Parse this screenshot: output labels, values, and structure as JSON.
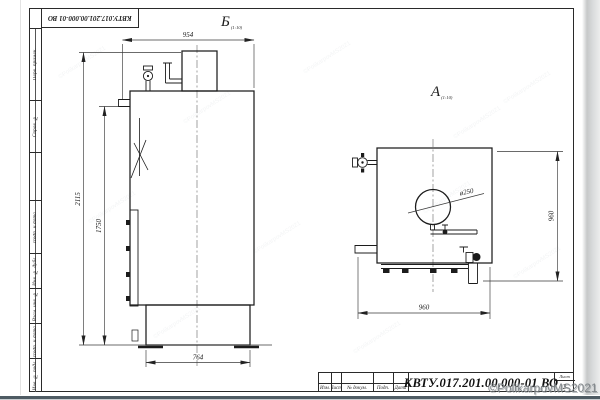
{
  "sheet": {
    "corner_stamp": "КВТУ.017.201.00.000-01 ВО"
  },
  "strip": {
    "cells": [
      "Перв. примен.",
      "Справ. №",
      "",
      "Подп. и дата",
      "Инв. № дубл.",
      "Взам. инв. №",
      "Подп. и дата",
      "Инв. № подл."
    ]
  },
  "views": {
    "b": {
      "label": "Б",
      "scale": "(1:10)",
      "dims": {
        "top_width": "954",
        "overall_height": "2115",
        "pipe_height": "1750",
        "base_width": "764"
      }
    },
    "a": {
      "label": "А",
      "scale": "(1:10)",
      "dims": {
        "diameter": "ø250",
        "height": "960",
        "width": "960"
      }
    }
  },
  "title_block": {
    "designation": "КВТУ.017.201.00.000-01  ВО",
    "row_labels": [
      "Изм.",
      "Лист",
      "№ докум.",
      "Подп.",
      "Дата"
    ],
    "sheet_label": "Лист",
    "sheet_number": "2"
  },
  "watermark": {
    "text": "©PolikarpovMS2021"
  },
  "colors": {
    "line": "#1c1c1c",
    "page_edge_shadow": "#4e5b63",
    "watermark": "#82878b"
  }
}
